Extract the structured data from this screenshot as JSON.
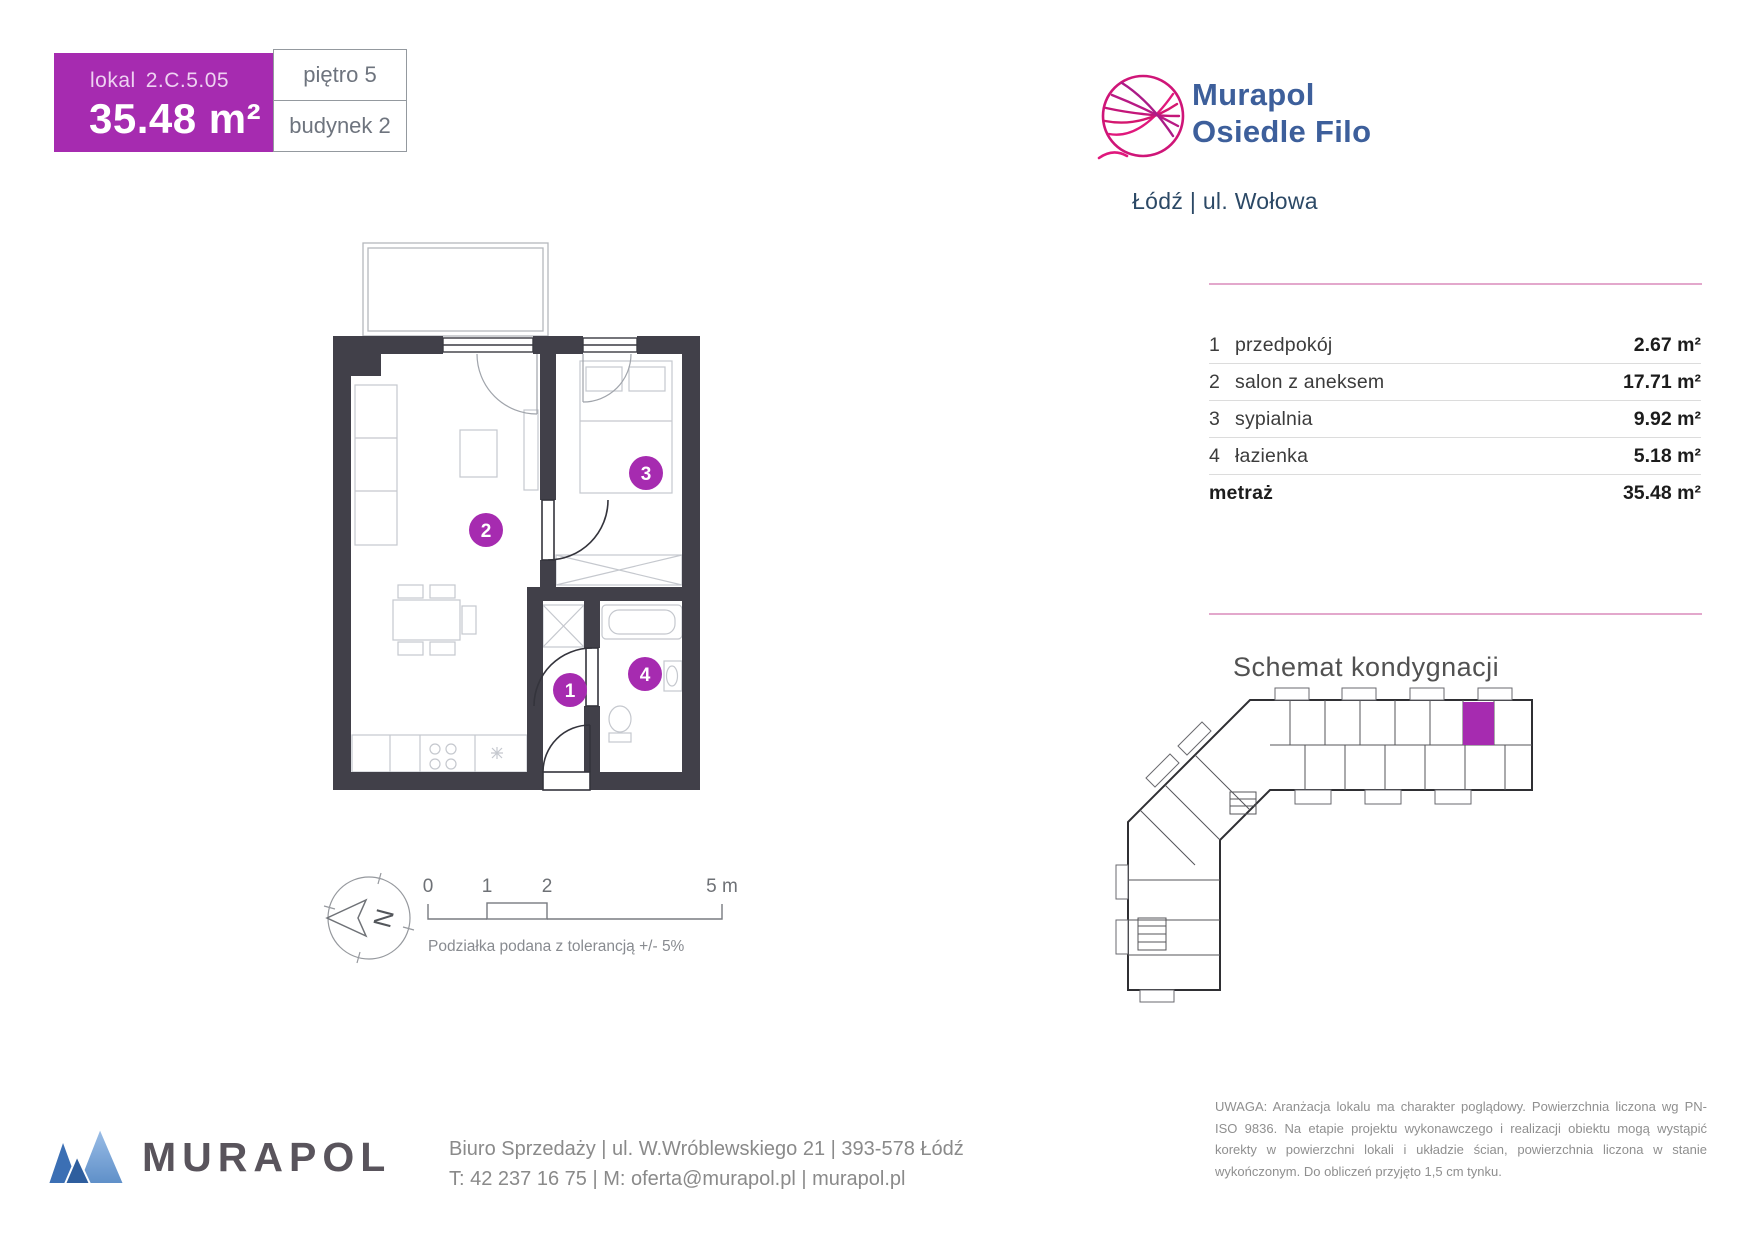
{
  "unit_card": {
    "lokal_prefix": "lokal",
    "lokal_code": "2.C.5.05",
    "area_value": "35.48 m²",
    "floor_label": "piętro 5",
    "building_label": "budynek 2"
  },
  "brand": {
    "line1": "Murapol",
    "line2": "Osiedle Filo",
    "location": "Łódź | ul. Wołowa"
  },
  "rooms_table": {
    "rows": [
      {
        "no": "1",
        "name": "przedpokój",
        "area": "2.67 m²"
      },
      {
        "no": "2",
        "name": "salon z aneksem",
        "area": "17.71 m²"
      },
      {
        "no": "3",
        "name": "sypialnia",
        "area": "9.92 m²"
      },
      {
        "no": "4",
        "name": "łazienka",
        "area": "5.18 m²"
      }
    ],
    "total_label": "metraż",
    "total_value": "35.48 m²"
  },
  "schematic": {
    "title": "Schemat kondygnacji"
  },
  "scale_bar": {
    "t0": "0",
    "t1": "1",
    "t2": "2",
    "t5": "5 m",
    "tolerance_note": "Podziałka podana z tolerancją +/- 5%"
  },
  "compass": {
    "north": "N"
  },
  "footer": {
    "logo": "MURAPOL",
    "sales_line": "Biuro Sprzedaży | ul. W.Wróblewskiego 21 | 393-578 Łódź",
    "contact_line": "T: 42 237 16 75 | M: oferta@murapol.pl | murapol.pl"
  },
  "disclaimer": "UWAGA: Aranżacja lokalu ma charakter poglądowy. Powierzchnia liczona wg PN-ISO 9836. Na etapie projektu wykonawczego i realizacji obiektu mogą wystąpić korekty w powierzchni lokali i układzie ścian, powierzchnia liczona w stanie wykończonym. Do obliczeń przyjęto 1,5 cm tynku.",
  "colors": {
    "accent": "#A62BB0",
    "pink_rule": "#E3A8CC",
    "wall": "#414049",
    "brand_blue": "#3D5F9B",
    "logo_pink": "#D4176F"
  }
}
